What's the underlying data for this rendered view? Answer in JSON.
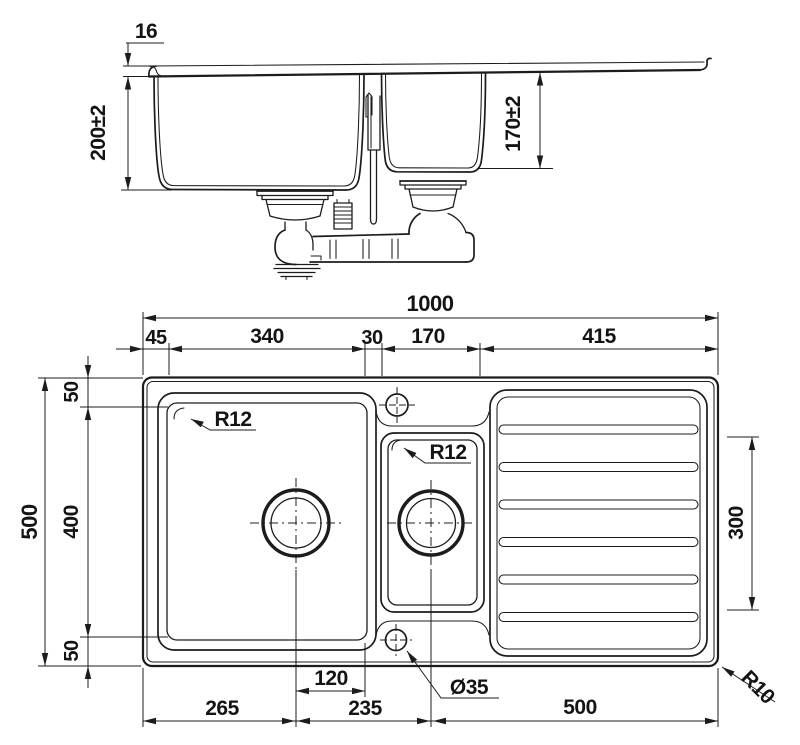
{
  "drawing": {
    "title": "sink-technical-drawing",
    "colors": {
      "line": "#1c1c1c",
      "background": "#ffffff"
    },
    "side_view": {
      "dim_edge_height": "16",
      "dim_main_bowl_depth": "200±2",
      "dim_small_bowl_depth": "170±2"
    },
    "plan_view": {
      "top": {
        "overall_width": "1000",
        "left_offset": "45",
        "main_bowl_width": "340",
        "divider_width": "30",
        "small_bowl_width": "170",
        "drainer_width": "415"
      },
      "left": {
        "overall_depth": "500",
        "top_offset": "50",
        "main_bowl_depth": "400",
        "bottom_offset": "50"
      },
      "right": {
        "drainer_rib_length": "300"
      },
      "bottom": {
        "drain_to_bowl_edge": "120",
        "left_edge_to_main_drain": "265",
        "main_drain_to_small_drain": "235",
        "small_drain_to_right_edge": "500"
      },
      "labels": {
        "main_bowl_corner_radius": "R12",
        "small_bowl_corner_radius": "R12",
        "hole_diameter": "Ø35",
        "sink_corner_radius": "R10"
      }
    }
  }
}
